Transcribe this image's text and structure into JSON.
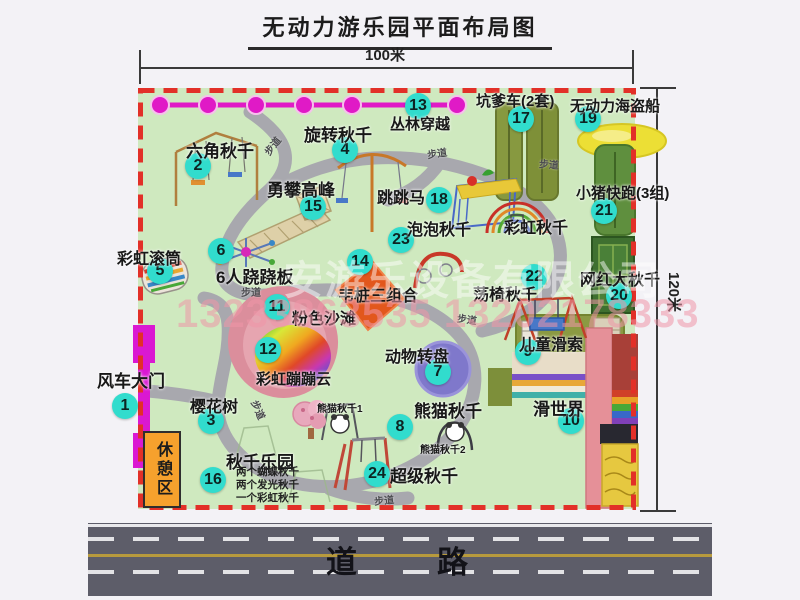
{
  "title": "无动力游乐园平面布局图",
  "dimensions": {
    "width_label": "100米",
    "height_label": "120米"
  },
  "road": {
    "label": "道　　路"
  },
  "watermark": {
    "company": "安游乐设备有限公司",
    "phone": "13233863535 13202178333"
  },
  "park": {
    "rest_area_label": "休憩区",
    "path_label_text": "步道",
    "attractions": [
      {
        "n": 1,
        "label": "风车大门",
        "bx": 125,
        "by": 406,
        "lx": 97,
        "ly": 367,
        "fs": 17
      },
      {
        "n": 2,
        "label": "六角秋千",
        "bx": 198,
        "by": 166,
        "lx": 186,
        "ly": 137,
        "fs": 17
      },
      {
        "n": 3,
        "label": "樱花树",
        "bx": 211,
        "by": 421,
        "lx": 190,
        "ly": 393,
        "fs": 16
      },
      {
        "n": 4,
        "label": "旋转秋千",
        "bx": 345,
        "by": 150,
        "lx": 304,
        "ly": 121,
        "fs": 17
      },
      {
        "n": 5,
        "label": "彩虹滚筒",
        "bx": 160,
        "by": 271,
        "lx": 117,
        "ly": 245,
        "fs": 16
      },
      {
        "n": 6,
        "label": "6人跷跷板",
        "bx": 221,
        "by": 251,
        "lx": 216,
        "ly": 263,
        "fs": 17
      },
      {
        "n": 7,
        "label": "动物转盘",
        "bx": 438,
        "by": 372,
        "lx": 385,
        "ly": 343,
        "fs": 16
      },
      {
        "n": 8,
        "label": "熊猫秋千",
        "bx": 400,
        "by": 427,
        "lx": 414,
        "ly": 397,
        "fs": 17
      },
      {
        "n": 9,
        "label": "儿童滑索",
        "bx": 528,
        "by": 352,
        "lx": 519,
        "ly": 331,
        "fs": 16
      },
      {
        "n": 10,
        "label": "滑世界",
        "bx": 571,
        "by": 421,
        "lx": 533,
        "ly": 395,
        "fs": 17
      },
      {
        "n": 11,
        "label": "粉色沙滩",
        "bx": 277,
        "by": 307,
        "lx": 292,
        "ly": 305,
        "fs": 16
      },
      {
        "n": 12,
        "label": "彩虹蹦蹦云",
        "bx": 268,
        "by": 350,
        "lx": 256,
        "ly": 368,
        "fs": 15
      },
      {
        "n": 13,
        "label": "丛林穿越",
        "bx": 418,
        "by": 106,
        "lx": 390,
        "ly": 113,
        "fs": 15
      },
      {
        "n": 14,
        "label": "韦桩三组合",
        "bx": 360,
        "by": 262,
        "lx": 338,
        "ly": 282,
        "fs": 16
      },
      {
        "n": 15,
        "label": "勇攀高峰",
        "bx": 313,
        "by": 207,
        "lx": 267,
        "ly": 176,
        "fs": 17
      },
      {
        "n": 16,
        "label": "秋千乐园",
        "bx": 213,
        "by": 480,
        "lx": 226,
        "ly": 448,
        "fs": 17
      },
      {
        "n": 17,
        "label": "坑爹车(2套)",
        "bx": 521,
        "by": 119,
        "lx": 476,
        "ly": 90,
        "fs": 15
      },
      {
        "n": 18,
        "label": "跳跳马",
        "bx": 439,
        "by": 200,
        "lx": 377,
        "ly": 184,
        "fs": 16
      },
      {
        "n": 19,
        "label": "无动力海盗船",
        "bx": 588,
        "by": 119,
        "lx": 570,
        "ly": 95,
        "fs": 15
      },
      {
        "n": 20,
        "label": "网红大秋千",
        "bx": 619,
        "by": 296,
        "lx": 580,
        "ly": 266,
        "fs": 16
      },
      {
        "n": 21,
        "label": "小猪快跑(3组)",
        "bx": 604,
        "by": 211,
        "lx": 576,
        "ly": 182,
        "fs": 15
      },
      {
        "n": 22,
        "label": "荡椅秋千",
        "bx": 534,
        "by": 277,
        "lx": 473,
        "ly": 281,
        "fs": 16
      },
      {
        "n": 23,
        "label": "泡泡秋千",
        "bx": 401,
        "by": 240,
        "lx": 407,
        "ly": 216,
        "fs": 16
      },
      {
        "n": 24,
        "label": "超级秋千",
        "bx": 377,
        "by": 474,
        "lx": 390,
        "ly": 462,
        "fs": 17
      }
    ],
    "plain_labels": [
      {
        "text": "彩虹秋千",
        "x": 504,
        "y": 214,
        "fs": 16
      },
      {
        "text": "熊猫秋千1",
        "x": 317,
        "y": 400,
        "fs": 10
      },
      {
        "text": "熊猫秋千2",
        "x": 420,
        "y": 441,
        "fs": 10
      }
    ],
    "path_label_positions": [
      {
        "x": 262,
        "y": 138,
        "r": -52
      },
      {
        "x": 427,
        "y": 145,
        "r": -8
      },
      {
        "x": 539,
        "y": 156,
        "r": 4
      },
      {
        "x": 241,
        "y": 284,
        "r": 0
      },
      {
        "x": 457,
        "y": 311,
        "r": 8
      },
      {
        "x": 249,
        "y": 402,
        "r": 66
      },
      {
        "x": 374,
        "y": 492,
        "r": -6
      }
    ],
    "swing_park_notes": [
      "两个蝴蝶秋千",
      "两个发光秋千",
      "一个彩虹秋千"
    ]
  }
}
